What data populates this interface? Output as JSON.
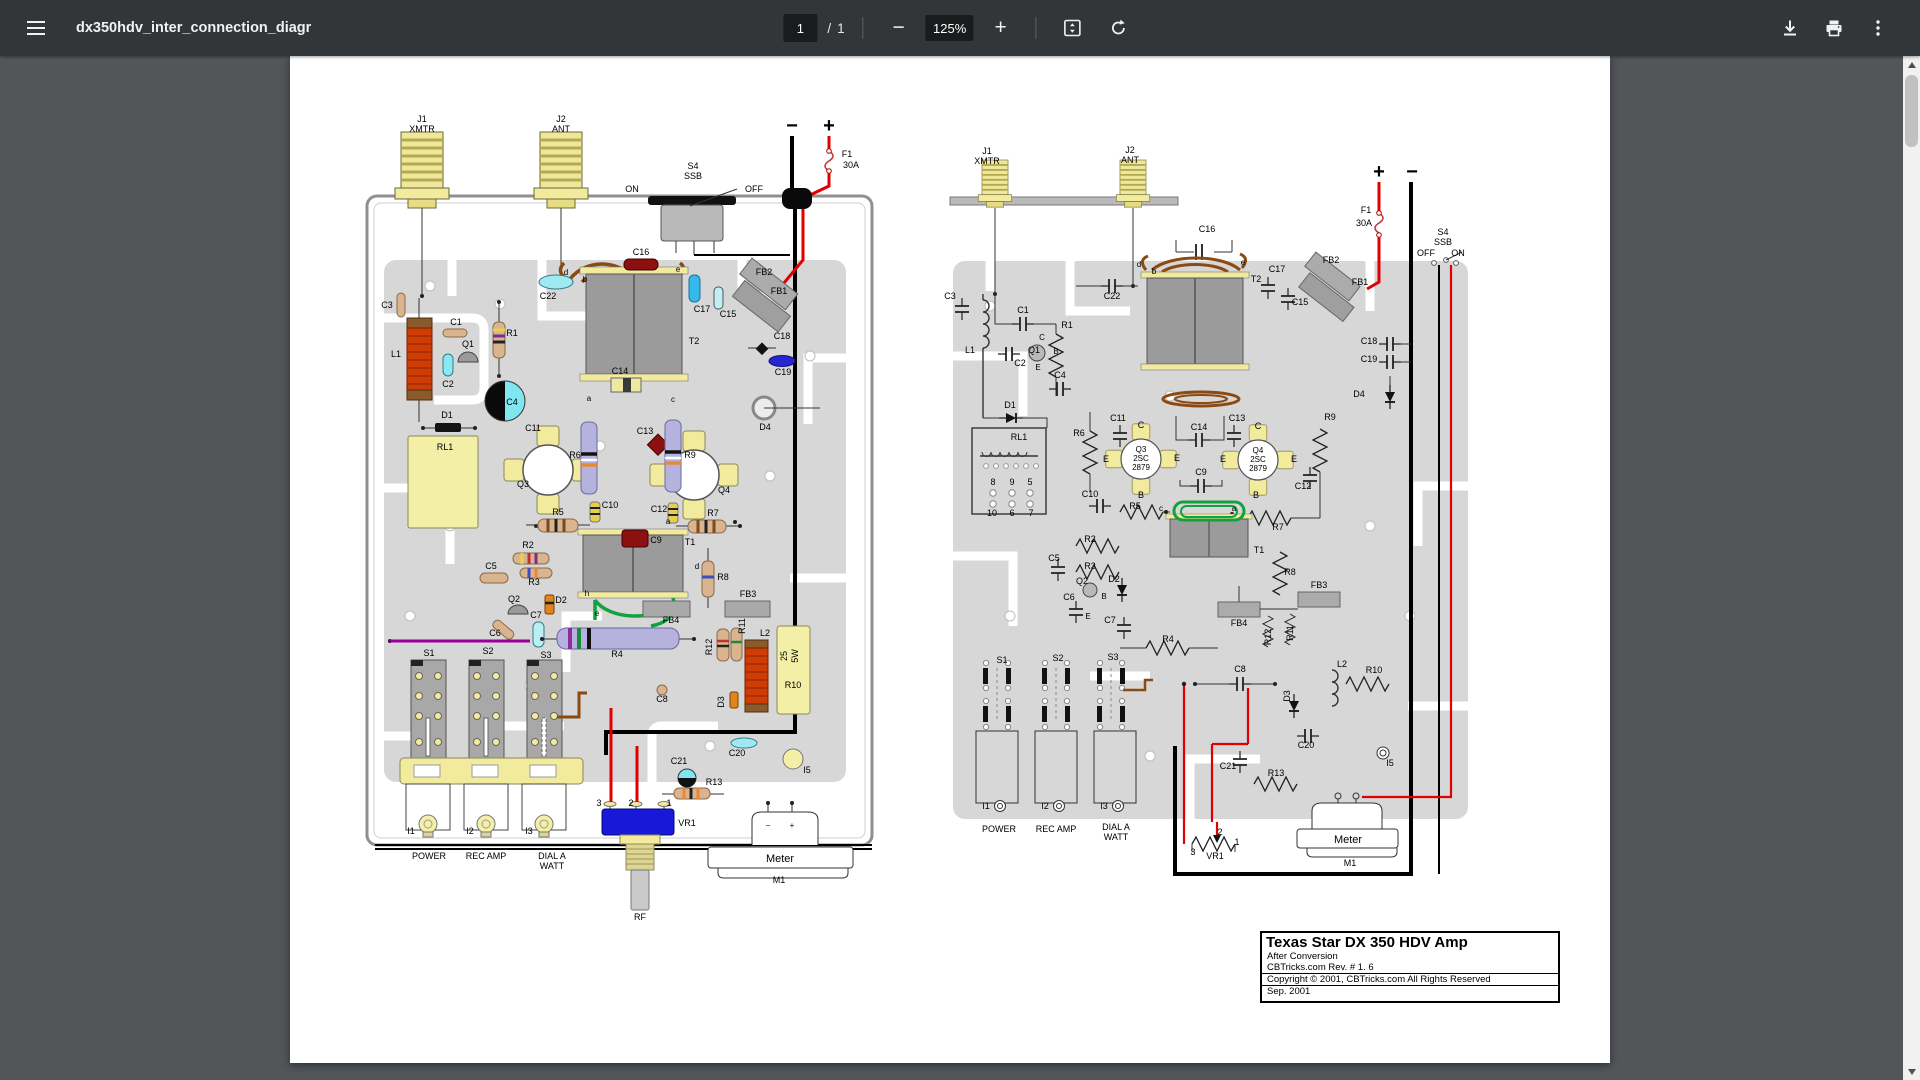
{
  "toolbar": {
    "filename": "dx350hdv_inter_connection_diagr",
    "page_current": "1",
    "page_separator": "/",
    "page_total": "1",
    "zoom_level": "125%",
    "zoom_out_label": "−",
    "zoom_in_label": "+"
  },
  "title_block": {
    "title": "Texas Star DX 350 HDV Amp",
    "line1": "After Conversion",
    "line2": "CBTricks.com Rev. # 1. 6",
    "line3": "Copyright © 2001, CBTricks.com All Rights Reserved",
    "line4": "Sep. 2001"
  },
  "colors": {
    "toolbar_bg": "#323639",
    "canvas_bg": "#525659",
    "page_bg": "#ffffff",
    "trace_gray": "#d7d7d7",
    "component_yellow": "#f2eb9e",
    "wire_red": "#e00000",
    "wire_green": "#12a13e",
    "wire_brown": "#8a4a12",
    "wire_purple": "#990099",
    "cap_cyan": "#9ee9f2",
    "cap_darkred": "#8c1010",
    "resistor_lavender": "#b5b3dd",
    "resistor_tan": "#d9b48e",
    "vr1_blue": "#1818d8"
  },
  "diagram_labels": {
    "left": [
      {
        "t": "J1",
        "x": 132,
        "y": 66
      },
      {
        "t": "XMTR",
        "x": 132,
        "y": 76
      },
      {
        "t": "J2",
        "x": 271,
        "y": 66
      },
      {
        "t": "ANT",
        "x": 271,
        "y": 76
      },
      {
        "t": "S4",
        "x": 403,
        "y": 113
      },
      {
        "t": "SSB",
        "x": 403,
        "y": 123
      },
      {
        "t": "ON",
        "x": 342,
        "y": 136
      },
      {
        "t": "OFF",
        "x": 464,
        "y": 136
      },
      {
        "t": "−",
        "x": 502,
        "y": 76,
        "s": 20,
        "b": 1
      },
      {
        "t": "+",
        "x": 539,
        "y": 76,
        "s": 20,
        "b": 1
      },
      {
        "t": "F1",
        "x": 557,
        "y": 101
      },
      {
        "t": "30A",
        "x": 561,
        "y": 112
      },
      {
        "t": "C16",
        "x": 351,
        "y": 199
      },
      {
        "t": "C22",
        "x": 258,
        "y": 243
      },
      {
        "t": "C17",
        "x": 412,
        "y": 256
      },
      {
        "t": "C15",
        "x": 438,
        "y": 261
      },
      {
        "t": "FB2",
        "x": 474,
        "y": 219
      },
      {
        "t": "FB1",
        "x": 489,
        "y": 238
      },
      {
        "t": "T2",
        "x": 404,
        "y": 288
      },
      {
        "t": "d",
        "x": 276,
        "y": 219,
        "s": 8
      },
      {
        "t": "b",
        "x": 295,
        "y": 226,
        "s": 8
      },
      {
        "t": "e",
        "x": 388,
        "y": 216,
        "s": 8
      },
      {
        "t": "C18",
        "x": 492,
        "y": 283
      },
      {
        "t": "C19",
        "x": 493,
        "y": 319
      },
      {
        "t": "D4",
        "x": 475,
        "y": 374
      },
      {
        "t": "C14",
        "x": 330,
        "y": 318
      },
      {
        "t": "a",
        "x": 299,
        "y": 345,
        "s": 8
      },
      {
        "t": "c",
        "x": 383,
        "y": 346,
        "s": 8
      },
      {
        "t": "C3",
        "x": 97,
        "y": 252
      },
      {
        "t": "L1",
        "x": 106,
        "y": 301
      },
      {
        "t": "C1",
        "x": 166,
        "y": 269
      },
      {
        "t": "Q1",
        "x": 178,
        "y": 291
      },
      {
        "t": "C2",
        "x": 158,
        "y": 331
      },
      {
        "t": "R1",
        "x": 222,
        "y": 280
      },
      {
        "t": "D1",
        "x": 157,
        "y": 362
      },
      {
        "t": "RL1",
        "x": 155,
        "y": 394
      },
      {
        "t": "C4",
        "x": 222,
        "y": 349
      },
      {
        "t": "C11",
        "x": 243,
        "y": 375
      },
      {
        "t": "R6",
        "x": 285,
        "y": 402
      },
      {
        "t": "Q3",
        "x": 233,
        "y": 431
      },
      {
        "t": "C13",
        "x": 355,
        "y": 378
      },
      {
        "t": "R9",
        "x": 400,
        "y": 402
      },
      {
        "t": "Q4",
        "x": 434,
        "y": 437
      },
      {
        "t": "C10",
        "x": 320,
        "y": 452
      },
      {
        "t": "C12",
        "x": 369,
        "y": 456
      },
      {
        "t": "R5",
        "x": 268,
        "y": 459
      },
      {
        "t": "R7",
        "x": 423,
        "y": 460
      },
      {
        "t": "C9",
        "x": 366,
        "y": 487
      },
      {
        "t": "T1",
        "x": 400,
        "y": 489
      },
      {
        "t": "a",
        "x": 378,
        "y": 468,
        "s": 8
      },
      {
        "t": "d",
        "x": 407,
        "y": 513,
        "s": 8
      },
      {
        "t": "h",
        "x": 297,
        "y": 540,
        "s": 8
      },
      {
        "t": "e",
        "x": 307,
        "y": 560,
        "s": 8
      },
      {
        "t": "R2",
        "x": 238,
        "y": 492
      },
      {
        "t": "R3",
        "x": 244,
        "y": 529
      },
      {
        "t": "C5",
        "x": 201,
        "y": 513
      },
      {
        "t": "Q2",
        "x": 224,
        "y": 546
      },
      {
        "t": "D2",
        "x": 271,
        "y": 547
      },
      {
        "t": "C6",
        "x": 205,
        "y": 580
      },
      {
        "t": "C7",
        "x": 246,
        "y": 562
      },
      {
        "t": "R4",
        "x": 327,
        "y": 601
      },
      {
        "t": "FB4",
        "x": 381,
        "y": 567
      },
      {
        "t": "FB3",
        "x": 458,
        "y": 541
      },
      {
        "t": "R8",
        "x": 433,
        "y": 524
      },
      {
        "t": "R12",
        "x": 422,
        "y": 591,
        "r": -90
      },
      {
        "t": "R11",
        "x": 455,
        "y": 570,
        "r": -90
      },
      {
        "t": "L2",
        "x": 475,
        "y": 580
      },
      {
        "t": "D3",
        "x": 434,
        "y": 646,
        "r": -90
      },
      {
        "t": "25",
        "x": 497,
        "y": 600,
        "r": -90
      },
      {
        "t": "5W",
        "x": 508,
        "y": 600,
        "r": -90
      },
      {
        "t": "R10",
        "x": 503,
        "y": 632
      },
      {
        "t": "C8",
        "x": 372,
        "y": 646
      },
      {
        "t": "C20",
        "x": 447,
        "y": 700
      },
      {
        "t": "I5",
        "x": 517,
        "y": 717
      },
      {
        "t": "C21",
        "x": 389,
        "y": 708
      },
      {
        "t": "R13",
        "x": 424,
        "y": 729
      },
      {
        "t": "S1",
        "x": 139,
        "y": 600
      },
      {
        "t": "S2",
        "x": 198,
        "y": 598
      },
      {
        "t": "S3",
        "x": 256,
        "y": 602
      },
      {
        "t": "I1",
        "x": 121,
        "y": 778
      },
      {
        "t": "I2",
        "x": 180,
        "y": 778
      },
      {
        "t": "I3",
        "x": 239,
        "y": 778
      },
      {
        "t": "POWER",
        "x": 139,
        "y": 803
      },
      {
        "t": "REC AMP",
        "x": 196,
        "y": 803
      },
      {
        "t": "DIAL A",
        "x": 262,
        "y": 803
      },
      {
        "t": "WATT",
        "x": 262,
        "y": 813
      },
      {
        "t": "3",
        "x": 309,
        "y": 750
      },
      {
        "t": "2",
        "x": 341,
        "y": 750
      },
      {
        "t": "1",
        "x": 379,
        "y": 750
      },
      {
        "t": "VR1",
        "x": 397,
        "y": 770
      },
      {
        "t": "RF",
        "x": 350,
        "y": 864
      },
      {
        "t": "−",
        "x": 478,
        "y": 772,
        "s": 8
      },
      {
        "t": "+",
        "x": 502,
        "y": 772,
        "s": 8
      },
      {
        "t": "Meter",
        "x": 490,
        "y": 806,
        "s": 11
      },
      {
        "t": "M1",
        "x": 489,
        "y": 827
      }
    ],
    "right": [
      {
        "t": "J1",
        "x": 697,
        "y": 98
      },
      {
        "t": "XMTR",
        "x": 697,
        "y": 108
      },
      {
        "t": "J2",
        "x": 840,
        "y": 97
      },
      {
        "t": "ANT",
        "x": 840,
        "y": 107
      },
      {
        "t": "C16",
        "x": 917,
        "y": 176
      },
      {
        "t": "+",
        "x": 1089,
        "y": 122,
        "s": 20,
        "b": 1
      },
      {
        "t": "−",
        "x": 1122,
        "y": 122,
        "s": 20,
        "b": 1
      },
      {
        "t": "F1",
        "x": 1076,
        "y": 157
      },
      {
        "t": "30A",
        "x": 1074,
        "y": 170
      },
      {
        "t": "S4",
        "x": 1153,
        "y": 179
      },
      {
        "t": "SSB",
        "x": 1153,
        "y": 189
      },
      {
        "t": "OFF",
        "x": 1136,
        "y": 200
      },
      {
        "t": "ON",
        "x": 1168,
        "y": 200
      },
      {
        "t": "C3",
        "x": 660,
        "y": 243
      },
      {
        "t": "C22",
        "x": 822,
        "y": 243
      },
      {
        "t": "C17",
        "x": 987,
        "y": 216
      },
      {
        "t": "C15",
        "x": 1010,
        "y": 249
      },
      {
        "t": "FB2",
        "x": 1041,
        "y": 207
      },
      {
        "t": "FB1",
        "x": 1070,
        "y": 229
      },
      {
        "t": "T2",
        "x": 966,
        "y": 226
      },
      {
        "t": "d",
        "x": 849,
        "y": 211,
        "s": 8
      },
      {
        "t": "b",
        "x": 864,
        "y": 218,
        "s": 8
      },
      {
        "t": "e",
        "x": 953,
        "y": 209,
        "s": 8
      },
      {
        "t": "C18",
        "x": 1079,
        "y": 288
      },
      {
        "t": "C19",
        "x": 1079,
        "y": 306
      },
      {
        "t": "D4",
        "x": 1069,
        "y": 341
      },
      {
        "t": "C1",
        "x": 733,
        "y": 257
      },
      {
        "t": "R1",
        "x": 777,
        "y": 272
      },
      {
        "t": "L1",
        "x": 680,
        "y": 297
      },
      {
        "t": "Q1",
        "x": 744,
        "y": 297
      },
      {
        "t": "C",
        "x": 752,
        "y": 284,
        "s": 8
      },
      {
        "t": "B",
        "x": 766,
        "y": 298,
        "s": 8
      },
      {
        "t": "E",
        "x": 748,
        "y": 314,
        "s": 8
      },
      {
        "t": "C2",
        "x": 730,
        "y": 310
      },
      {
        "t": "C4",
        "x": 770,
        "y": 322
      },
      {
        "t": "D1",
        "x": 720,
        "y": 352
      },
      {
        "t": "RL1",
        "x": 729,
        "y": 384
      },
      {
        "t": "8",
        "x": 703,
        "y": 429
      },
      {
        "t": "9",
        "x": 722,
        "y": 429
      },
      {
        "t": "5",
        "x": 740,
        "y": 429
      },
      {
        "t": "10",
        "x": 702,
        "y": 460
      },
      {
        "t": "6",
        "x": 722,
        "y": 460
      },
      {
        "t": "7",
        "x": 741,
        "y": 460
      },
      {
        "t": "R6",
        "x": 789,
        "y": 380
      },
      {
        "t": "C11",
        "x": 828,
        "y": 365
      },
      {
        "t": "Q3",
        "x": 851,
        "y": 396,
        "s": 8
      },
      {
        "t": "2SC",
        "x": 851,
        "y": 405,
        "s": 8
      },
      {
        "t": "2879",
        "x": 851,
        "y": 414,
        "s": 8
      },
      {
        "t": "E",
        "x": 816,
        "y": 406,
        "s": 9
      },
      {
        "t": "C",
        "x": 851,
        "y": 372,
        "s": 9
      },
      {
        "t": "E",
        "x": 887,
        "y": 405,
        "s": 9
      },
      {
        "t": "B",
        "x": 851,
        "y": 442,
        "s": 9
      },
      {
        "t": "C14",
        "x": 909,
        "y": 374
      },
      {
        "t": "C13",
        "x": 947,
        "y": 365
      },
      {
        "t": "Q4",
        "x": 968,
        "y": 397,
        "s": 8
      },
      {
        "t": "2SC",
        "x": 968,
        "y": 406,
        "s": 8
      },
      {
        "t": "2879",
        "x": 968,
        "y": 415,
        "s": 8
      },
      {
        "t": "E",
        "x": 933,
        "y": 406,
        "s": 9
      },
      {
        "t": "C",
        "x": 968,
        "y": 373,
        "s": 9
      },
      {
        "t": "E",
        "x": 1004,
        "y": 406,
        "s": 9
      },
      {
        "t": "B",
        "x": 966,
        "y": 442,
        "s": 9
      },
      {
        "t": "R9",
        "x": 1040,
        "y": 364
      },
      {
        "t": "C10",
        "x": 800,
        "y": 441
      },
      {
        "t": "C12",
        "x": 1013,
        "y": 433
      },
      {
        "t": "C9",
        "x": 911,
        "y": 419
      },
      {
        "t": "R5",
        "x": 845,
        "y": 453
      },
      {
        "t": "c",
        "x": 871,
        "y": 455,
        "s": 8
      },
      {
        "t": "a",
        "x": 944,
        "y": 455,
        "s": 8
      },
      {
        "t": "R7",
        "x": 988,
        "y": 474
      },
      {
        "t": "T1",
        "x": 969,
        "y": 497
      },
      {
        "t": "R2",
        "x": 800,
        "y": 486
      },
      {
        "t": "C5",
        "x": 764,
        "y": 505
      },
      {
        "t": "R3",
        "x": 800,
        "y": 513
      },
      {
        "t": "Q2",
        "x": 792,
        "y": 528
      },
      {
        "t": "D2",
        "x": 824,
        "y": 526
      },
      {
        "t": "C6",
        "x": 779,
        "y": 544
      },
      {
        "t": "B",
        "x": 814,
        "y": 543,
        "s": 8
      },
      {
        "t": "E",
        "x": 798,
        "y": 563,
        "s": 8
      },
      {
        "t": "C7",
        "x": 820,
        "y": 567
      },
      {
        "t": "FB3",
        "x": 1029,
        "y": 532
      },
      {
        "t": "FB4",
        "x": 949,
        "y": 570
      },
      {
        "t": "R8",
        "x": 1000,
        "y": 519
      },
      {
        "t": "R12",
        "x": 981,
        "y": 581,
        "r": -90
      },
      {
        "t": "R11",
        "x": 1003,
        "y": 577,
        "r": -90
      },
      {
        "t": "R4",
        "x": 878,
        "y": 586
      },
      {
        "t": "S1",
        "x": 712,
        "y": 607
      },
      {
        "t": "S2",
        "x": 768,
        "y": 605
      },
      {
        "t": "S3",
        "x": 823,
        "y": 604
      },
      {
        "t": "C8",
        "x": 950,
        "y": 616
      },
      {
        "t": "D3",
        "x": 1000,
        "y": 640,
        "r": -90
      },
      {
        "t": "L2",
        "x": 1052,
        "y": 611
      },
      {
        "t": "R10",
        "x": 1084,
        "y": 617
      },
      {
        "t": "C20",
        "x": 1016,
        "y": 692
      },
      {
        "t": "C21",
        "x": 938,
        "y": 713
      },
      {
        "t": "R13",
        "x": 986,
        "y": 720
      },
      {
        "t": "I5",
        "x": 1100,
        "y": 710
      },
      {
        "t": "I1",
        "x": 696,
        "y": 753
      },
      {
        "t": "I2",
        "x": 755,
        "y": 753
      },
      {
        "t": "I3",
        "x": 814,
        "y": 753
      },
      {
        "t": "POWER",
        "x": 709,
        "y": 776
      },
      {
        "t": "REC AMP",
        "x": 766,
        "y": 776
      },
      {
        "t": "DIAL A",
        "x": 826,
        "y": 774
      },
      {
        "t": "WATT",
        "x": 826,
        "y": 784
      },
      {
        "t": "2",
        "x": 930,
        "y": 779
      },
      {
        "t": "1",
        "x": 947,
        "y": 789
      },
      {
        "t": "3",
        "x": 903,
        "y": 799
      },
      {
        "t": "VR1",
        "x": 925,
        "y": 803
      },
      {
        "t": "Meter",
        "x": 1058,
        "y": 787,
        "s": 11
      },
      {
        "t": "M1",
        "x": 1060,
        "y": 810
      }
    ]
  }
}
